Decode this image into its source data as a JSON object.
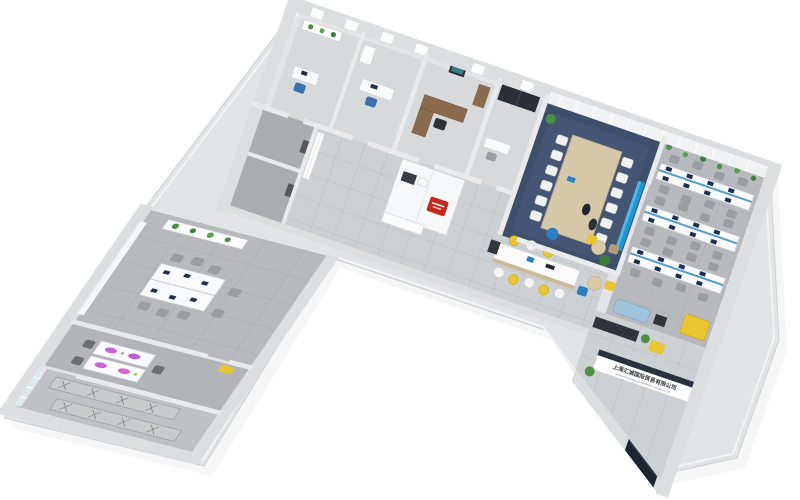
{
  "scene_title": "3D isometric office floor plan render",
  "background_color": "#ffffff",
  "reception": {
    "sign_line1": "上海汇城国际贸易有限公司",
    "sign_line2": "SHANGHAI HUICHENG INTERNATIONAL TRADING CO.,LTD",
    "desk_color": "#ffffff",
    "counter_top_color": "#2a3240"
  },
  "palette": {
    "outer_wall": "#e3e4e7",
    "outer_wall_edge": "#cfd1d4",
    "inner_wall": "#f4f5f6",
    "wall_shadow": "#d7d9db",
    "corridor_tile": "#ced1d3",
    "tile_line": "#bec1c4",
    "utility_floor": "#aaacaf",
    "conference_carpet": "#3e4f6b",
    "conference_carpet_light": "#4a5c7d",
    "office_carpet": "#b7b9bc",
    "desk_white": "#f9fafb",
    "chair_grey": "#9a9ea3",
    "chair_white": "#eff1f3",
    "wood": "#d6c7a9",
    "manager_wood": "#8a6b4e",
    "wardrobe_black": "#2b2e34",
    "accent_yellow": "#e9c531",
    "accent_blue": "#2e7fc2",
    "accent_lightblue": "#9fc3d8",
    "accent_red": "#c5281c",
    "plant_green": "#4c8f45",
    "plant_green_dark": "#3e7d3a",
    "screen_blue": "#1c96d4",
    "monitor_navy": "#1e2f4f",
    "purple_glow": "#c84fd0",
    "entrance_navy": "#1e2530",
    "curtain": "#f0f2f3",
    "glass": "#dfe9ee"
  },
  "rooms": [
    {
      "name": "corner-office",
      "items": [
        "plant-shelf",
        "desk",
        "blue-chair"
      ]
    },
    {
      "name": "team-office",
      "items": [
        "desk",
        "monitor",
        "blue-chair",
        "cabinet"
      ]
    },
    {
      "name": "manager-office",
      "items": [
        "l-desk",
        "chair",
        "wall-picture",
        "cabinet"
      ]
    },
    {
      "name": "wardrobe-room",
      "items": [
        "black-wardrobes",
        "desk"
      ]
    },
    {
      "name": "conference-room",
      "items": [
        "long-table",
        "12-white-chairs",
        "wall-screen",
        "plants",
        "two-people",
        "curtains"
      ]
    },
    {
      "name": "open-office",
      "items": [
        "3-desk-rows",
        "monitors",
        "grey-chairs",
        "hanging-plants",
        "yellow-cabinet",
        "blue-sofa"
      ]
    },
    {
      "name": "pantry",
      "items": [
        "white-cabinets",
        "red-sign",
        "appliance"
      ]
    },
    {
      "name": "coffee-bar",
      "items": [
        "island-counter",
        "yellow-stools",
        "white-stools",
        "coffee-machine"
      ]
    },
    {
      "name": "lounge",
      "items": [
        "bistro-tables",
        "yellow-chair",
        "blue-chair",
        "taupe-chair"
      ]
    },
    {
      "name": "reception",
      "items": [
        "sign-desk",
        "plants",
        "media-wall",
        "yellow-armchair"
      ]
    },
    {
      "name": "utility-rooms",
      "items": []
    },
    {
      "name": "workstation-office",
      "items": [
        "6-desk-cluster",
        "monitors",
        "grey-chairs",
        "plant-shelf",
        "window-curtains"
      ]
    },
    {
      "name": "creative-room",
      "items": [
        "two-desks",
        "purple-glow-devices",
        "dark-chairs",
        "yellow-floor-sign"
      ]
    },
    {
      "name": "storage-room",
      "items": [
        "metal-shelving",
        "corner-windows"
      ]
    },
    {
      "name": "entrance",
      "items": [
        "navy-door"
      ]
    }
  ]
}
